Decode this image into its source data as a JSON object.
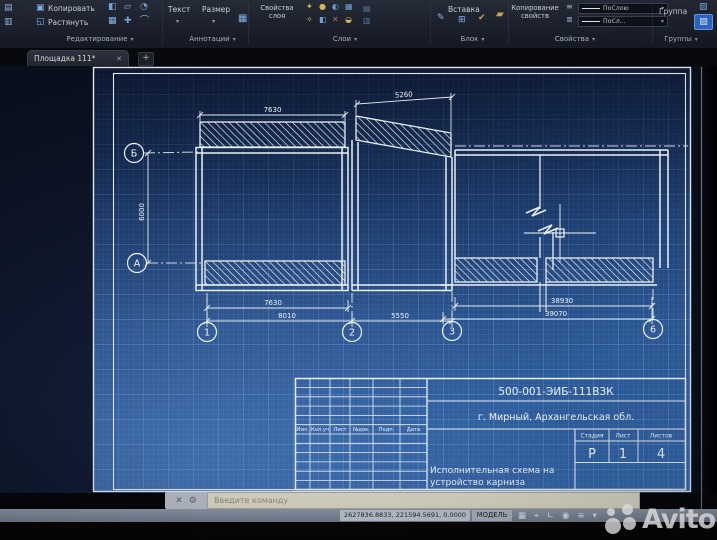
{
  "window": {
    "tab_label": "Площадка 111*"
  },
  "ribbon": {
    "buttons": {
      "copy": "Копировать",
      "stretch": "Растянуть",
      "text": "Текст",
      "dimension": "Размер",
      "layer_properties": "Свойства слоя",
      "insert": "Вставка",
      "match_properties": "Копирование свойств",
      "group": "Группа"
    },
    "dropdowns": {
      "bylayer_full": "ПоСлою",
      "bylayer_short": "ПоСл..."
    },
    "panel_titles": {
      "modify": "Редактирование",
      "annotation": "Аннотации",
      "layers": "Слои",
      "block": "Блок",
      "properties": "Свойства",
      "groups": "Группы"
    }
  },
  "drawing": {
    "axis_labels": {
      "top": "Б",
      "bottom": "А",
      "v1": "1",
      "v2": "2",
      "v3": "3",
      "v6": "6"
    },
    "dimensions": {
      "top_left": "7630",
      "top_right": "5260",
      "height_left": "6000",
      "bottom_left_inner": "7630",
      "bottom_left_outer": "8010",
      "bottom_middle": "5550",
      "bottom_right_inner": "38930",
      "bottom_right_outer": "39070"
    }
  },
  "title_block": {
    "document_number": "500-001-ЭИБ-111ВЗК",
    "location": "г. Мирный, Архангельская обл.",
    "description_line1": "Исполнительная схема на",
    "description_line2": "устройство карниза",
    "revision_columns": [
      "Изм.",
      "Кол.уч",
      "Лист",
      "№док.",
      "Подп.",
      "Дата"
    ],
    "stage_header": "Стадия",
    "sheet_header": "Лист",
    "sheets_header": "Листов",
    "stage_value": "Р",
    "sheet_value": "1",
    "sheets_value": "4"
  },
  "command_line": {
    "prompt": "Введите команду"
  },
  "status_bar": {
    "coordinates": "2627836.8833, 221594.5691, 0.0000",
    "model": "МОДЕЛЬ"
  },
  "watermark": {
    "brand": "Avito"
  },
  "icons": {
    "tab_close": "✕",
    "new_tab": "+",
    "chevron": "▾",
    "qa": [
      "▤",
      "▥"
    ],
    "copy": "▣",
    "stretch": "◱",
    "modify": [
      "◧",
      "▱",
      "◔",
      "▦",
      "✚",
      "⌒"
    ],
    "annotation_chevron": "▾",
    "table": "▦",
    "layers": [
      "✦",
      "●",
      "◐",
      "▦",
      "✧",
      "◧",
      "✕",
      "◒"
    ],
    "layers_extra": [
      "▤",
      "▥"
    ],
    "block_edit": "✎",
    "block_insert": "⊞",
    "block_check": "✔",
    "properties_brush": "▰",
    "lines_a": "≡",
    "lines_b": "≣",
    "group_a": "▧",
    "group_b": "▨",
    "cmd_close": "✕",
    "cmd_tool": "⚙",
    "status": [
      "▦",
      "⌖",
      "∟",
      "◉",
      "≡",
      "▾"
    ]
  },
  "colors": {
    "accent_blue": "#2e6bd0",
    "paper_line": "#e9eff6",
    "grid_blue": "#2f5f9f",
    "command_field": "#d9d6c6"
  }
}
